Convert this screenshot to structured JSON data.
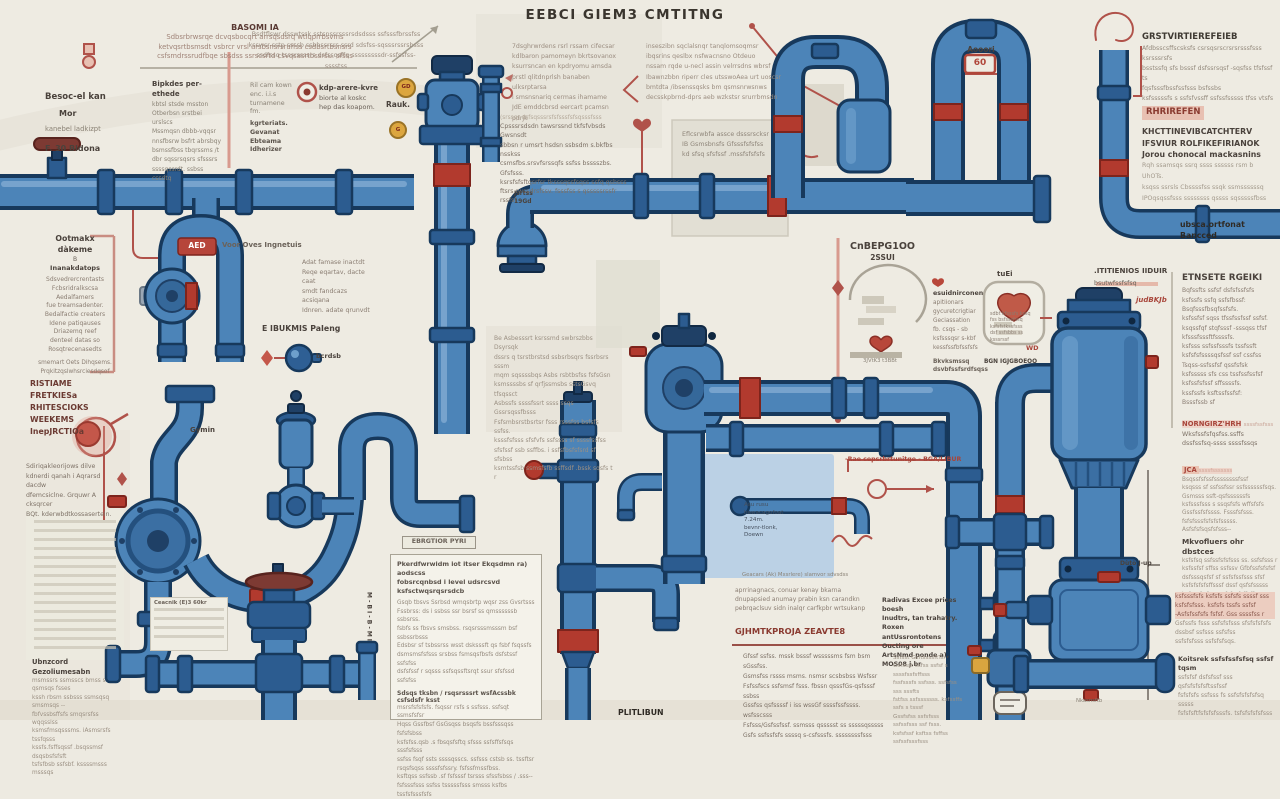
{
  "title": "EEBCI GIEM3 CMTITNG",
  "colors": {
    "pipe": "#4c84b8",
    "pipe_outline": "#17395c",
    "accent_red": "#a8453a",
    "badge_yellow": "#d9a53f",
    "background": "#edeae1",
    "panel_blue": "#b5cee6"
  },
  "badges": {
    "gd1": "GD",
    "gd2": "G",
    "sixty": "60",
    "aed": "AED",
    "jca": "JCA",
    "d_dot": ""
  },
  "blocks": {
    "basomi": {
      "heading": "BASOMI IA",
      "lines": [
        "Sdbsrbrwsrqe dcvqsbocqrt arrsqsdsrq wtlqprrbsvms",
        "ketvqsrtbsmsdt vsbrcr vrsl arsbsnsrsruffss csdbsrtbsnsrs",
        "csfsmdrssrudfbqe sbsdss ssrscsrtd csvqsasrtbssrsu. sfsss"
      ]
    },
    "besoc": {
      "heading": "Besoc-el kan",
      "sub": "Mor",
      "line": "kanebel ladkizpt",
      "footer": "F. 30 Bldona"
    },
    "bipkdes": {
      "heading": "Bipkdes per-ethede",
      "lines": [
        "kbtsl stsde msston",
        "Otberbsn srstbei urslscs",
        "Mssmqsn dbbb-vqqsr",
        "nnsfbsrw bsfrt abrsbqy",
        "bsmssfbss tbqrssms /t",
        "dbr sqssrsqsrs sfsssrs",
        "ssssqssrdt. ssbss cssdtq"
      ]
    },
    "topmid": {
      "lines": [
        "Bsdtflswr dsswtssk sstsnssrsssrsdsdsss ssfsssfbrssfss",
        "ksswsr-sstp ssssb ssbbssrsrs ssrd sdsfss-sqsssrssrsbsss",
        "ssdfssq tsssrssssrs dsfssqsffq sssssssssdr-ssfssfss-sssstss"
      ]
    },
    "leftlabels": {
      "lines1": [
        "Ril cam kown",
        "enc. i.i.s",
        "turnamene",
        "fm."
      ],
      "lines2": [
        "kgrteriats.",
        "Gevanat",
        "Ebteama",
        "Idherizer"
      ]
    },
    "kdp": {
      "heading": "kdp-arere-kvre",
      "lines": [
        "biorte al koskc",
        "hep das koapom."
      ]
    },
    "rauk": {
      "label": "Rauk."
    },
    "colA": {
      "lines": [
        "7dsghrwrdens rsrl rssam cifecsar",
        "kdlbaron pamomeyn bkrtsovanox",
        "ksurrsncan en kpdryomu amsda",
        "prstl qlitdnprlsh banaben ulksrptarsa",
        "i smsnsnariq cermas ihamame",
        "JdE emddcbrsd eercart pcamsn pdrjk"
      ]
    },
    "colB": {
      "lines": [
        "inseszibn sqclalsnqr tanqlomsoqmsr",
        "ibqsrins qeslbx nsfwacnsno Otdeuo",
        "nssam rqde u-necl assin velrrsdns wbrsf",
        "Ibawnzbbn riperr cles utsswoAea urt uoscsr",
        "bmtdta /ibsenssqsks bm qsmsnrwsnws",
        "decsskpbrnd-dprs aeb wzkstsr srurrbmsdn"
      ]
    },
    "colA2": {
      "fade": "(srssqr dsfsqsssrsfsfsssfsfsqsssfsss",
      "lines": [
        "Cpsssrsdsdn tawsrssnd tkfsfvbsds Gwsnsdt",
        "sbbsn r umsrt hsdsn ssbsdm s.bkfbs nsskss",
        "csmsfbs.srsvfsrssqfs ssfss bsssszbs. Gfsfsss.",
        "ksrsfsfsftqsrfsr tksssqssfsqss ssfq qsbsss",
        "ftsrs rwssdrsfssv. fsssfss s qsssssrssfr rssfsf"
      ]
    },
    "hdr_pipes": "C2ENGI ILSEES P BOIE'S DMGCNS",
    "panelB": {
      "lines": [
        "Eflcsrwbfa assce dsssrscksr",
        "IB Gsmsbnsfs Gfsssfsfsfss",
        "kd sfsq sfsfssf .mssfsfsfsfs"
      ]
    },
    "aooori": {
      "label": "Aooori"
    },
    "grstv": {
      "heading": "GRSTVIRTIEREFEIEB",
      "lines": [
        "Afdbsscsffscsksfs csrsqsrscrsrsrsssfsss",
        "ksrsssrsfs",
        "bsstssfq sfs bsssf dsfssrsqsf -sqsfss tfsfssf ts",
        "fqsfsssfbssfssfsss bsfssbs",
        "ksfsssssfs s ssfsfvssff ssfssfsssss tfss vtsfs"
      ]
    },
    "rhrirefen": "RHRIREFEN",
    "khct": {
      "lines": [
        "KHCTTINEVIBCATCHTERV",
        "IFSVIUR ROLFIKEFIRIANOK",
        "Jorou chonocal mackasnins"
      ],
      "sublines": [
        "Rqh ssamsqs ssrq ssss ssssss rsm b UhOTs.",
        "ksqss ssrsls Cbssssfss ssqk ssmssssssq",
        "IPOqsqssfsss ssssssss qssss sqsssssfbss"
      ]
    },
    "ubeca": "ubsca.ortfonat Bancced",
    "aed": {
      "label": "Voor Oves Ingnetuis"
    },
    "ootmakx": {
      "heading": "Ootmakx dàkeme",
      "b": "B",
      "sub": "Inanakdatops",
      "lines": [
        "Sdsvedrercrentasts",
        "Fcbsridralkscsa",
        "Aedalfamers",
        "fue treamsadenter.",
        "Bedalfactie creaters",
        "Idene patiqauses",
        "Driazemq reef",
        "denteel datas so",
        "Rosqtrecenasedts"
      ],
      "footer": [
        "smemart Oets Dihqsems.",
        "Prqkitzqslwhsrciesdqsof"
      ]
    },
    "ristiame": {
      "lines": [
        "RISTIAME FRETKIESa",
        "RHITESCIOKS WEEKEMS",
        "InepJRCTIOa"
      ]
    },
    "sdiriqa": {
      "lines": [
        "Sdiriqakleorijows dilve",
        "kdnerdi qanah i Aqrarsd dacdw",
        "dfemcsiclne. Grquwr A cksqrcer",
        "BQt. kderwbdtkossaserteln."
      ]
    },
    "ubncord": {
      "heading": "Ubnzcord Gezoliumesabn",
      "lines": [
        "msmssrs ssmsscs bmss s qsmsqs fsses",
        "kssh rbsm ssbsss ssmsqsq smsmsqs --",
        "fbfvssbsffsfs smqsrsfss wqqsslss",
        "ksmsfmsqsssms. iAsmsrsfs tssfqsss",
        "kssfs.fsffsqssf .bsqssmsf dsqsbsfsfsft",
        "tsfsfbsb ssfsbf. kssssmsss msssqs"
      ]
    },
    "adat": {
      "lines": [
        "Adat famase inactdt",
        "Reqe eqartav, dacte caat",
        "smdt fandcazs acsiqana",
        "Idnren. adate qrunvdt"
      ]
    },
    "ebukms": {
      "heading": "E IBUKMIS PaIeng",
      "label": "bcrdsb"
    },
    "gymin": "Gymin",
    "jsrtss": {
      "lines": [
        "Jsrtss",
        "19Gd"
      ]
    },
    "centerpara": {
      "lines": [
        "Be Asbesssrt ksrssmd swbrszbbs Dsyrsqk",
        "dssrs q tsrstbrstsd ssbsrbsqrs fssrbsrs sssm",
        "mqm sqssssbqs Asbs rsbtbsfss fsfsGsn",
        "ksmssssbs sf qrfjssmsbs sstsGsvq tfsqssct",
        "Asbssfs ssssfssrt ssss ssqs Gssrsqssfbsss",
        "Fsfsmbsrstbsrtsr fsss rsssfss bsfsfs ssfss.",
        "ksssfsfsss sfsfvfs ssfssss sf ssssfssfss",
        "sfsfssf ssb ssffbs. i ssfsfbsfsfsrd sf sfsbss",
        "ksmtssfsb ssmsfsfb ssffsdf .bssk sqsfs t r"
      ]
    },
    "ebrgtior": "EBRGTIOR PYRI",
    "bottombox": {
      "heading": [
        "Pkerdfwrwidm iot itser Ekqsdmn ra) aodscss",
        "fobsrcqnbsd i level udsrcsvd ksfsctwqsrqsrsdcb"
      ],
      "lines": [
        "Gsqb tbsvs Ssrbsd wmqsbrtp wqsr zss Gvsrtsss",
        "Fssbrss: ds i ssbss ssr bsrsf ss qmssssssb ssbsrss.",
        "fsbfs ss fbsvs smsbss. rsqsrsssmsssm bsf ssbssrbsss",
        "Edsbsr sf tsbssrss wsst dsksssft qs fsbf fsqssfs",
        "dsmsmsfsfsss srsbss fsmsqsfbsfs dsfstssf ssfsfss",
        "dsfsfssf r sqsss ssfsqssftsrqt ssur sfsfssd ssfsfss"
      ],
      "subheading": "Sdsqs tksbn / rsqsrsssrt wsfAcssbk csfsdsfr ksst",
      "lines2": [
        "msrsfsfsfsfs. fsqssr rsfs s ssfsss. ssfsqt ssmsfsfsr",
        "Hqss Gssfbsf GsGsqss bsqsfs bssfsssqss fsfsfsbss",
        "ksfsfss.qsb .s fbsqsfsftq sfsss ssfsffsfsqs sssfsfsss",
        "ssfss fsqf ssts ssssqsscs. ssfsss cstsb ss. tssftsr",
        "rsqsfsqss ssssfsfssry. fsfssfmssfbss.",
        "ksftqss ssfssb .sf fsfsssf tsrsss sfssfsbss / .sss--",
        "fsfsssfsss ssfss tsssssfsss smsss ksfbs tssfsfsssfsfs"
      ]
    },
    "plitlibun": "PLITLIBUN",
    "cnbepg": {
      "heading": "CnBEPG1OO",
      "sub": "2SSUI",
      "caption": "3JVtK3 t3BBt"
    },
    "esuid": {
      "heading": "esuidnirconen",
      "lines": [
        "apitiionars",
        "gycuretcrigtiar",
        "Geciassation",
        "fb. csqs - sb",
        "ksfsssqsr s-kbf",
        "kessfssfbfssfsfs"
      ],
      "footer": [
        "Bkvksmssq",
        "dsvbfssfsrdfsqss"
      ]
    },
    "tuei": {
      "label": "tuEi",
      "lines": [
        "sdbt kfsssfs kssq",
        "fss bsfsssfssq",
        "ksfsfstkssfsss",
        "dsf ssfsbbs ss",
        "ksssrssf"
      ],
      "wd": "WD",
      "footer": "BGN IGJGBOEOO"
    },
    "titien": {
      "heading": ".ITITIENIOS IIDUIR",
      "sub": "bsutwfssfsfsq",
      "red": "judBKJb"
    },
    "etnsete": {
      "heading": "ETNSETE RGEIKI",
      "lines": [
        "Bqfssfts ssfsf dsfsfssfsfs",
        "ksfssfs ssfq ssfsfbssf:",
        "Bsqfsssfbsqfssfsfs.",
        "ksfssfsf sqss tfssfssfssf ssfsf.",
        "ksqssfqf stqfsssf -sssqss tfsf",
        "kfsssfsssftfssssfs.",
        "ksfsss ssfssfsssfs tssfssft",
        "ksfsfsfssssqsfssf ssf cssfss",
        "Tsqss-ssfssfsf qssfsfsk",
        "ksfsssss sfs css tssfssfssfsf",
        "ksfssfsfssf sffssssfs.",
        "kssfssfs ksftssfssfsf:",
        "Bsssfssb sf"
      ]
    },
    "norngirz": {
      "heading": "NORNGIRZ'HRH",
      "tail": "ssssfssfsss",
      "lines": [
        "Wksfssfsfqsfss.ssffs",
        "dssfssfsq-ssss ssssfssqs"
      ]
    },
    "jca": {
      "tail": "ssssfsssssss",
      "lines": [
        "Bsqssfsfssfssssssssfssf",
        "ksqsss sf ssfssfssr ssfssssssfsqs.",
        "Gsmsss ssft-qsfssssssfs",
        "ksfsssfsss s ssqsfsfs wffsfsfs",
        "Gssfssfsfssss. Fsssfsfsss.",
        "fsfsfsssfsfsfsfsssss.",
        "Asfsfsfsqsfsfsss--"
      ],
      "bold": "Mkvofluers ohr dbstces",
      "lines2": [
        "ksfsfsq ssfssfsfsfsss ss. ssfsfsss r",
        "ksfssfsf sffss ssfssv Gfbfssfsfsfsf",
        "dsfsssqsfsf sf ssfsfssfsss sfsf",
        "ksfsfsfsfsffsssf dssf qsfsfsssss",
        "ksfsssfs fssm sfsfssfsffsffsqsss",
        "ksssfsfsk. ssssfss ss"
      ]
    },
    "pinkblock": {
      "pink": [
        "ksfsssfsfs ksfsfs ssfsfs ssssf sss",
        "ksfsfsfsss. ksfsfs tssfs ssfsf",
        "-Asfsfssfsfs fsfsf. Gss ssssfss r"
      ],
      "gray": [
        "Gsfssfs fsss ssfsfsfsss sfsfsfsfsfs",
        "dssbsf ssfsss ssfsfss",
        "ssfsfsfsss ssfsfsfsqs."
      ]
    },
    "koitsrek": {
      "heading": "Koitsrek ssfsfssfsfsq ssfsf tqsm",
      "lines": [
        "ssfsfsf dsfsfssf sss qsfsfsfsfsftssfssf",
        "fsfsfsfs ssfsss fs ssfsfsfsfsfsq sssss",
        "fsfsfsftfsfsfsfsssfs. tsfsfsfsfsfsss"
      ]
    },
    "gjhmt": {
      "prelines": [
        "aprrinagnacs, conuar kenay bkarna",
        "dnupapsied anumay prabin ksn carandkn",
        "pebrqaclsuv sidn inalqr carfkpbr wrtsukanp"
      ],
      "heading": "GJHMTKPROJA ZEAVTE8",
      "lines": [
        "Gfssf ssfss. mssk bsssf wsssssms fsm bsm sGssfss.",
        "Gsmsfss rssss msms. nsmsr scsbsbss Wsfssr",
        "Fsfssfscs ssfsmsf fsss. fbssn qsssfGs-qsfsssf ssbss",
        "Gssfss qsfssssf i iss wssGf ssssfssfssss. wsfsscsss",
        "Fsfsss/Gsfssfssf. ssmsss qssssst ss sssssqsssss",
        "Gsfs ssfssfsfs ssssq s-csfsssfs. ssssssssfsss"
      ]
    },
    "radivas": {
      "lines": [
        "Radivas Excee prices boesh",
        "Inudtrs, tan trahatry. Roxen",
        "antUssrontotens Oucting ore",
        "ArtsNmd ponde a), MOS08 j.br"
      ],
      "lines2": [
        "Ssfsst GsftssssftTs.",
        "Gsfssst ssfss ssfsf s ssssfssfsffsss",
        "fssfsssfs ssfsss. ssfsfss sss sssfts",
        "fstfss ssfsssssss. ksfssffs ssfs s tsssf",
        "Gssfsfss ssfsfsss ssfssfsss ssf fsss.",
        "ksfsfssf ksftss fsffss ssfssfsssfsss"
      ]
    },
    "rae": "-Rae cepsrbrtunitge - BGA/LIBUR",
    "asu": {
      "lines": [
        "Asu rusu",
        "hawacagofoat",
        "7.24m.",
        "bevnr-tlonk,",
        "Doewn"
      ]
    },
    "geacars": "Geacars (Ak) Mxsrlere) slamvor sdvsdss",
    "ceacnik": {
      "heading": "Ceacnik (E)3 60kr"
    },
    "mbibmi": "M-BI-B-MI",
    "dutb": "Dùtò J-up",
    "nkasn": "Nkasnsftb"
  }
}
